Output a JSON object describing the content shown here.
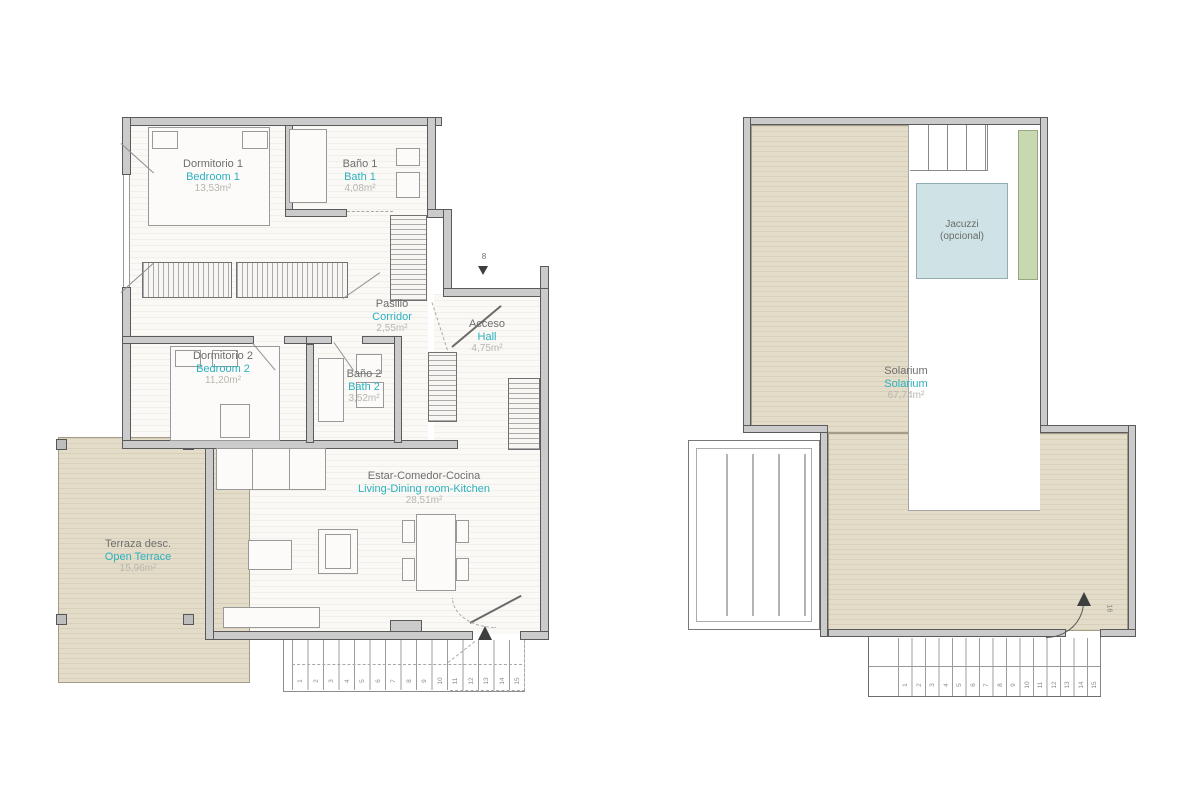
{
  "colors": {
    "teal_accent": "#2cb1bf",
    "wall_fill": "#cbcbcb",
    "wall_line": "#5a5a5a",
    "floor_white": "#faf9f6",
    "deck_beige": "#e3dcc9",
    "jacuzzi_fill": "#cfe3e6",
    "planter_green": "#c8d8b0",
    "label_gray": "#6e6e6e",
    "area_gray": "#b9b5ae"
  },
  "left_plan": {
    "rooms": {
      "bedroom1": {
        "es": "Dormitorio 1",
        "en": "Bedroom 1",
        "area": "13,53m²"
      },
      "bath1": {
        "es": "Baño 1",
        "en": "Bath 1",
        "area": "4,08m²"
      },
      "corridor": {
        "es": "Pasillo",
        "en": "Corridor",
        "area": "2,55m²"
      },
      "hall": {
        "es": "Acceso",
        "en": "Hall",
        "area": "4,75m²"
      },
      "bedroom2": {
        "es": "Dormitorio 2",
        "en": "Bedroom 2",
        "area": "11,20m²"
      },
      "bath2": {
        "es": "Baño 2",
        "en": "Bath 2",
        "area": "3,52m²"
      },
      "living": {
        "es": "Estar-Comedor-Cocina",
        "en": "Living-Dining room-Kitchen",
        "area": "28,51m²"
      },
      "terrace": {
        "es": "Terraza desc.",
        "en": "Open Terrace",
        "area": "15,96m²"
      }
    },
    "entry_marker": "8",
    "stairs": [
      "1",
      "2",
      "3",
      "4",
      "5",
      "6",
      "7",
      "8",
      "9",
      "10",
      "11",
      "12",
      "13",
      "14",
      "15"
    ]
  },
  "right_plan": {
    "rooms": {
      "solarium": {
        "es": "Solarium",
        "en": "Solarium",
        "area": "67,74m²"
      },
      "jacuzzi": {
        "line1": "Jacuzzi",
        "line2": "(opcional)"
      }
    },
    "stairs": [
      "1",
      "2",
      "3",
      "4",
      "5",
      "6",
      "7",
      "8",
      "9",
      "10",
      "11",
      "12",
      "13",
      "14",
      "15"
    ],
    "landing_number": "16"
  }
}
